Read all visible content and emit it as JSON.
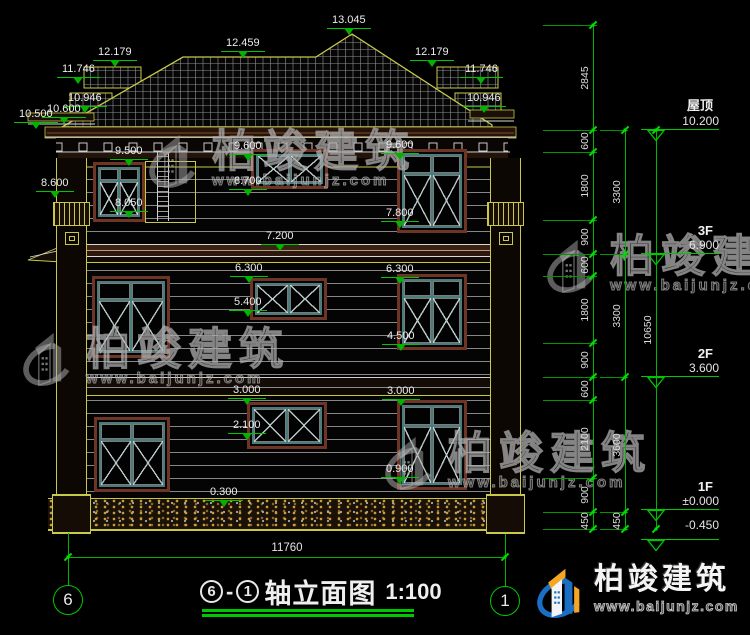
{
  "title": {
    "axis_left": "6",
    "axis_right": "1",
    "dash": "-",
    "text": "轴立面图",
    "scale": "1:100"
  },
  "brand": {
    "name": "柏竣建筑",
    "url": "www.baijunjz.com"
  },
  "bottom_dim": {
    "value": "11760"
  },
  "axes": [
    {
      "label": "6",
      "x": 68
    },
    {
      "label": "1",
      "x": 505
    }
  ],
  "facade_flags": [
    {
      "label": "13.045",
      "x": 327,
      "y": 14
    },
    {
      "label": "12.459",
      "x": 221,
      "y": 37
    },
    {
      "label": "12.179",
      "x": 93,
      "y": 46
    },
    {
      "label": "12.179",
      "x": 410,
      "y": 46
    },
    {
      "label": "11.746",
      "x": 57,
      "y": 63
    },
    {
      "label": "11.746",
      "x": 460,
      "y": 63
    },
    {
      "label": "10.946",
      "x": 63,
      "y": 92
    },
    {
      "label": "10.946",
      "x": 462,
      "y": 92
    },
    {
      "label": "10.600",
      "x": 42,
      "y": 103
    },
    {
      "label": "10.500",
      "x": 14,
      "y": 108
    },
    {
      "label": "9.500",
      "x": 110,
      "y": 145
    },
    {
      "label": "9.600",
      "x": 229,
      "y": 140
    },
    {
      "label": "9.600",
      "x": 381,
      "y": 139
    },
    {
      "label": "8.700",
      "x": 229,
      "y": 175
    },
    {
      "label": "8.600",
      "x": 36,
      "y": 177
    },
    {
      "label": "8.050",
      "x": 110,
      "y": 197
    },
    {
      "label": "7.800",
      "x": 381,
      "y": 207
    },
    {
      "label": "7.200",
      "x": 261,
      "y": 230
    },
    {
      "label": "6.300",
      "x": 230,
      "y": 262
    },
    {
      "label": "6.300",
      "x": 381,
      "y": 263
    },
    {
      "label": "5.400",
      "x": 229,
      "y": 296
    },
    {
      "label": "4.500",
      "x": 382,
      "y": 330
    },
    {
      "label": "3.000",
      "x": 228,
      "y": 384
    },
    {
      "label": "3.000",
      "x": 382,
      "y": 385
    },
    {
      "label": "2.100",
      "x": 228,
      "y": 419
    },
    {
      "label": "0.900",
      "x": 381,
      "y": 463
    },
    {
      "label": "0.300",
      "x": 205,
      "y": 486
    }
  ],
  "right_levels": [
    {
      "label": "屋顶",
      "value": "10.200",
      "y": 130,
      "value_below": false
    },
    {
      "label": "3F",
      "value": "6.900",
      "y": 254,
      "value_below": false
    },
    {
      "label": "2F",
      "value": "3.600",
      "y": 377,
      "value_below": false
    },
    {
      "label": "1F",
      "value": "±0.000",
      "y": 510,
      "value_below": false
    },
    {
      "label": "",
      "value": "-0.450",
      "y": 540,
      "value_below": true
    }
  ],
  "chains": [
    {
      "x": 593,
      "ticks": [
        25,
        130,
        152,
        220,
        254,
        276,
        343,
        377,
        400,
        478,
        512,
        529
      ],
      "labels": [
        "2845",
        "600",
        "1800",
        "900",
        "600",
        "1800",
        "900",
        "600",
        "2100",
        "900",
        "450"
      ]
    },
    {
      "x": 625,
      "ticks": [
        130,
        254,
        377,
        512,
        529
      ],
      "labels": [
        "3300",
        "3300",
        "3600",
        "450"
      ]
    },
    {
      "x": 656,
      "ticks": [
        130,
        529
      ],
      "labels": [
        "10650"
      ]
    }
  ],
  "windows": [
    {
      "x": 93,
      "y": 162,
      "w": 52,
      "h": 60,
      "transom": true
    },
    {
      "x": 251,
      "y": 149,
      "w": 77,
      "h": 40,
      "transom": false
    },
    {
      "x": 397,
      "y": 149,
      "w": 70,
      "h": 84,
      "transom": true
    },
    {
      "x": 92,
      "y": 276,
      "w": 78,
      "h": 82,
      "transom": true
    },
    {
      "x": 250,
      "y": 278,
      "w": 77,
      "h": 42,
      "transom": false
    },
    {
      "x": 397,
      "y": 274,
      "w": 70,
      "h": 76,
      "transom": true
    },
    {
      "x": 94,
      "y": 417,
      "w": 76,
      "h": 75,
      "transom": true
    },
    {
      "x": 247,
      "y": 402,
      "w": 80,
      "h": 47,
      "transom": false
    },
    {
      "x": 397,
      "y": 400,
      "w": 70,
      "h": 90,
      "transom": true
    }
  ],
  "watermarks": [
    {
      "x": 148,
      "y": 128
    },
    {
      "x": 546,
      "y": 233
    },
    {
      "x": 22,
      "y": 326
    },
    {
      "x": 384,
      "y": 430
    }
  ],
  "colors": {
    "dim_green": "#00c800",
    "roof_outline": "#c8c84a",
    "window_teal": "#4d7b7b",
    "trim_brown": "#6e3526",
    "brand_blue": "#1a6fc4",
    "brand_orange": "#f5a623"
  }
}
